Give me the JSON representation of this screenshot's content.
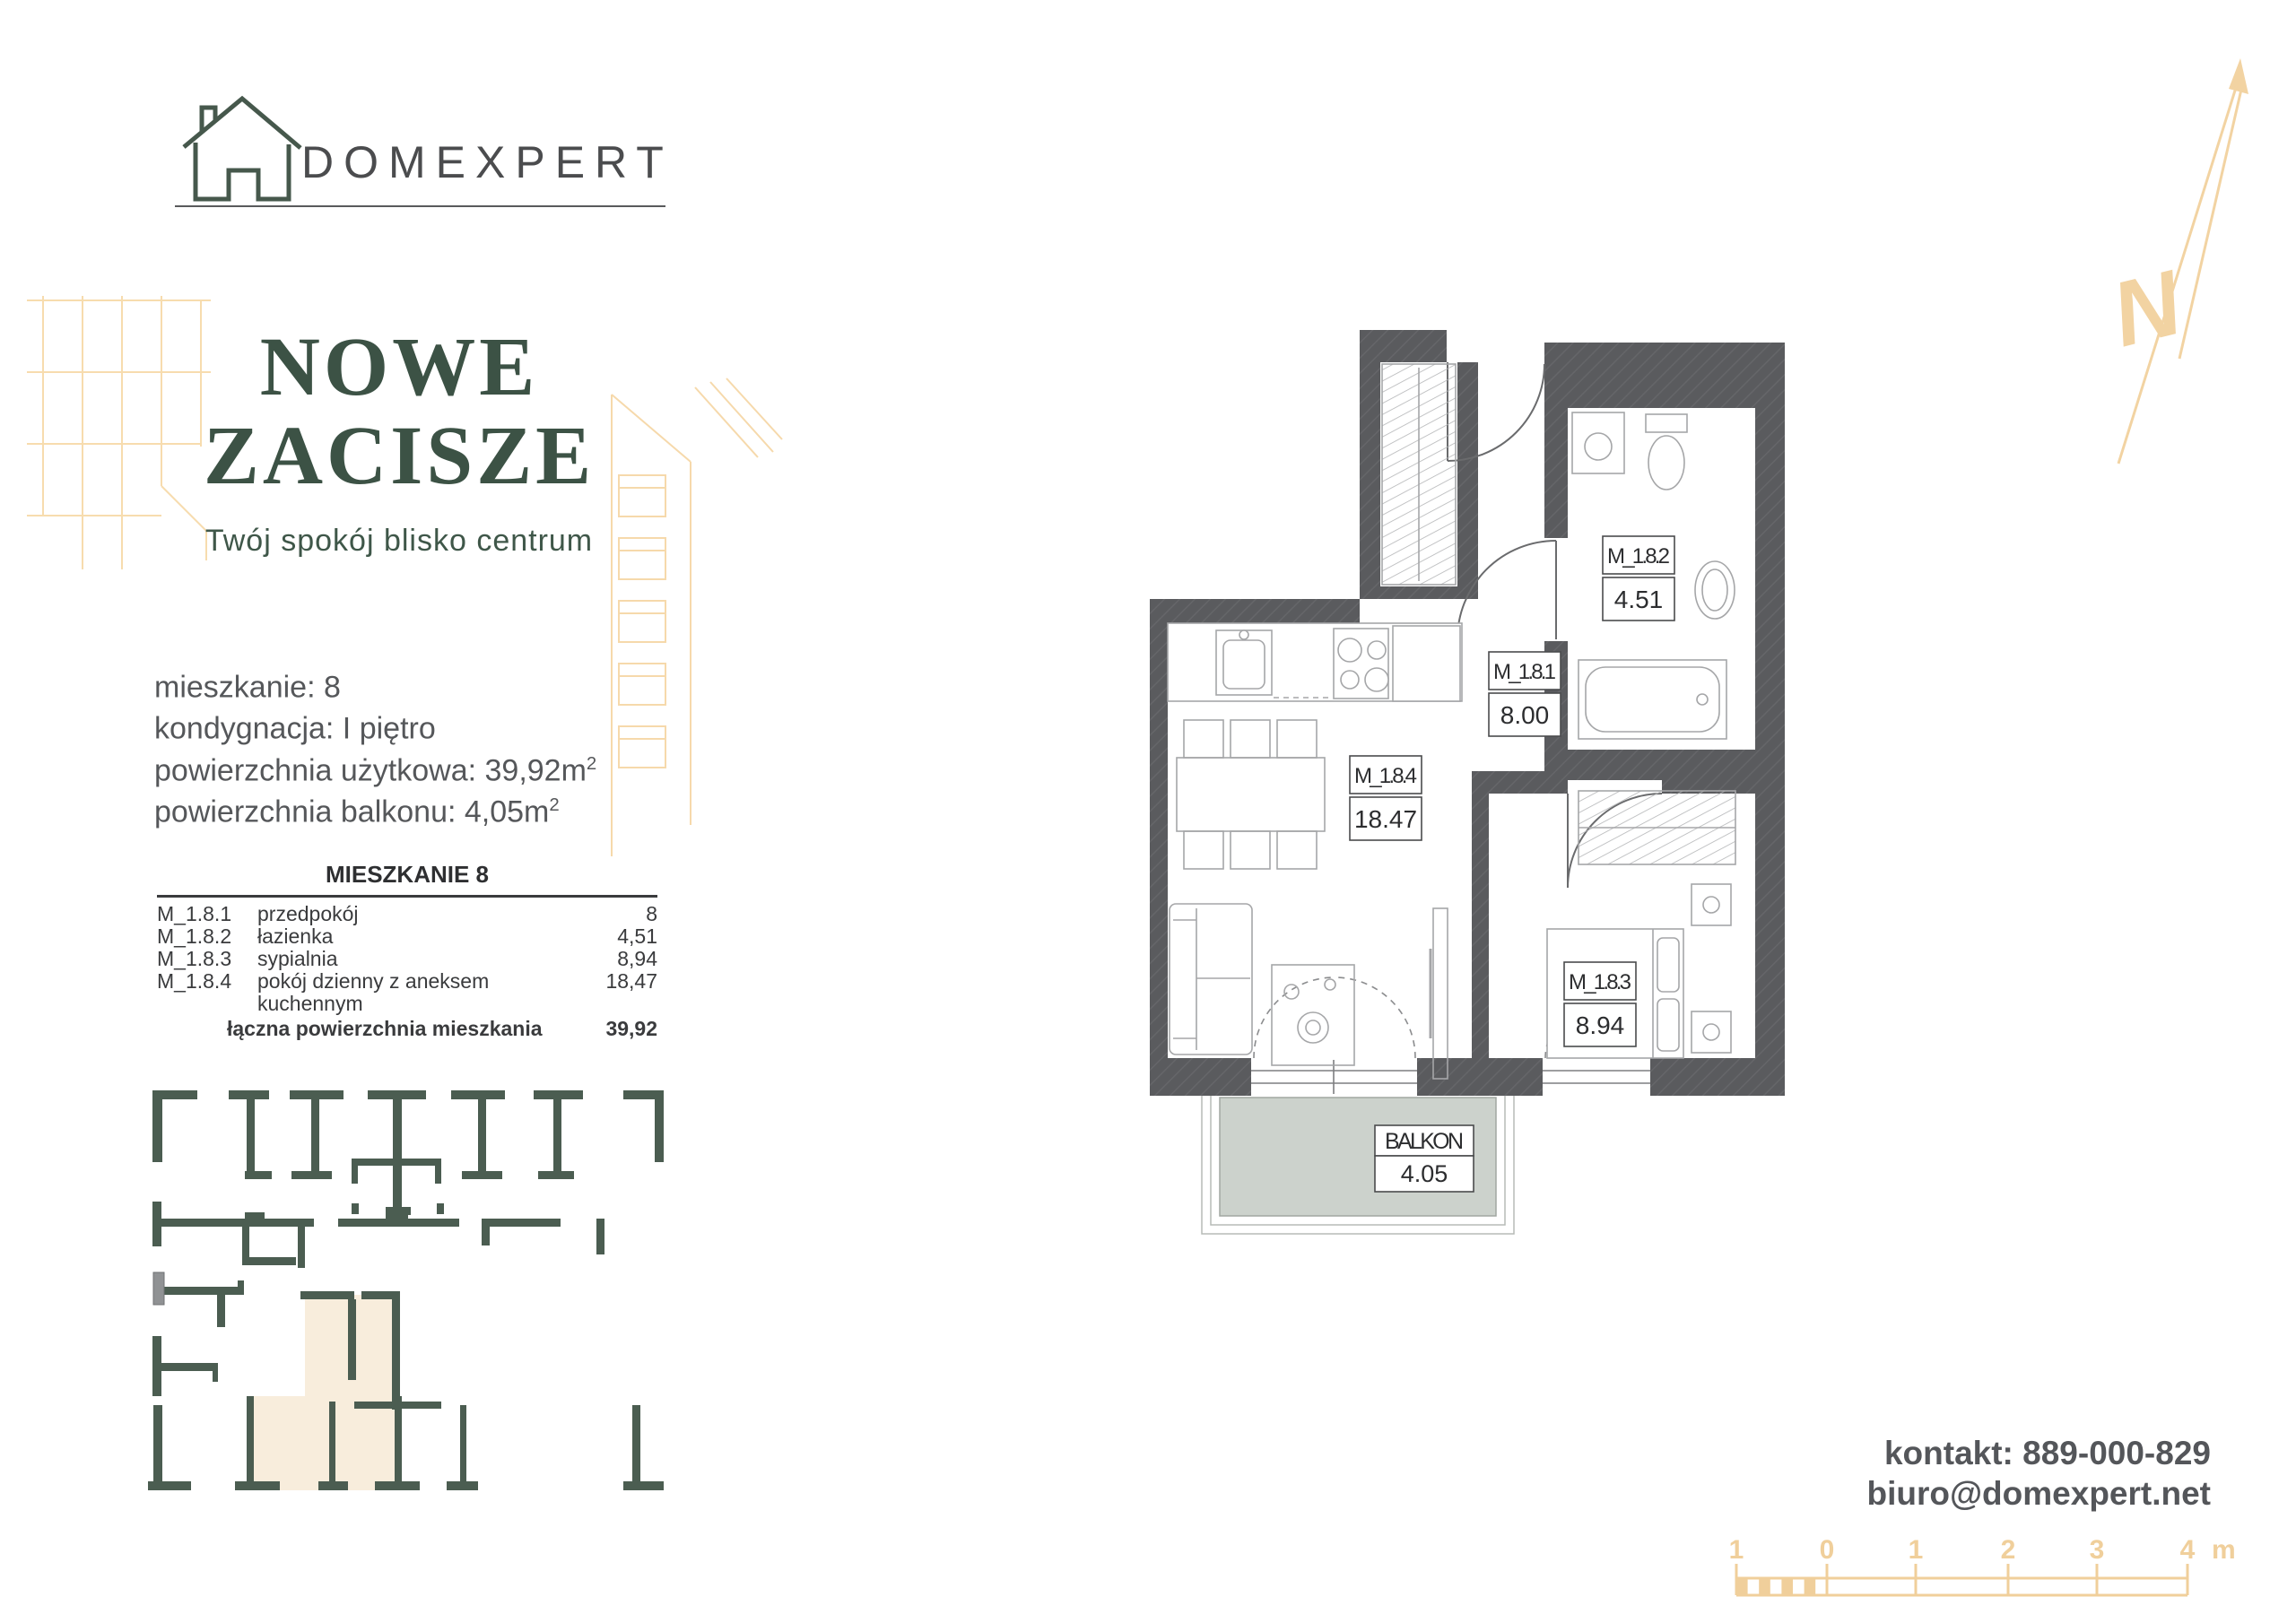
{
  "brand": {
    "name": "DOMEXPERT"
  },
  "hero": {
    "title_line1": "NOWE",
    "title_line2": "ZACISZE",
    "subtitle": "Twój spokój blisko centrum"
  },
  "unit_info": {
    "lines": [
      {
        "text": "mieszkanie: 8",
        "sup": ""
      },
      {
        "text": "kondygnacja: I piętro",
        "sup": ""
      },
      {
        "text": "powierzchnia użytkowa: 39,92m",
        "sup": "2"
      },
      {
        "text": "powierzchnia balkonu: 4,05m",
        "sup": "2"
      }
    ]
  },
  "area_table": {
    "title": "MIESZKANIE 8",
    "rows": [
      {
        "code": "M_1.8.1",
        "name": "przedpokój",
        "area": "8"
      },
      {
        "code": "M_1.8.2",
        "name": "łazienka",
        "area": "4,51"
      },
      {
        "code": "M_1.8.3",
        "name": "sypialnia",
        "area": "8,94"
      },
      {
        "code": "M_1.8.4",
        "name": "pokój dzienny z aneksem kuchennym",
        "area": "18,47"
      }
    ],
    "total": {
      "label": "łączna powierzchnia mieszkania",
      "value": "39,92"
    }
  },
  "plan": {
    "rooms": [
      {
        "code": "M_1.8.1",
        "area": "8.00"
      },
      {
        "code": "M_1.8.2",
        "area": "4.51"
      },
      {
        "code": "M_1.8.3",
        "area": "8.94"
      },
      {
        "code": "M_1.8.4",
        "area": "18.47"
      }
    ],
    "balcony": {
      "code": "BALKON",
      "area": "4.05"
    }
  },
  "contact": {
    "phone": "kontakt: 889-000-829",
    "email": "biuro@domexpert.net"
  },
  "scale_bar": {
    "labels": [
      "1",
      "0",
      "1",
      "2",
      "3",
      "4"
    ],
    "unit": "m"
  },
  "compass": {
    "label": "N"
  },
  "colors": {
    "brand_green": "#3c5245",
    "keyplan_green": "#4b5d51",
    "accent_gold": "#f2d3a2",
    "wall_gray": "#5a5b5e",
    "text_gray": "#55575a",
    "highlight_beige": "#f8eddc",
    "balcony_gray": "#ccd2cc"
  }
}
